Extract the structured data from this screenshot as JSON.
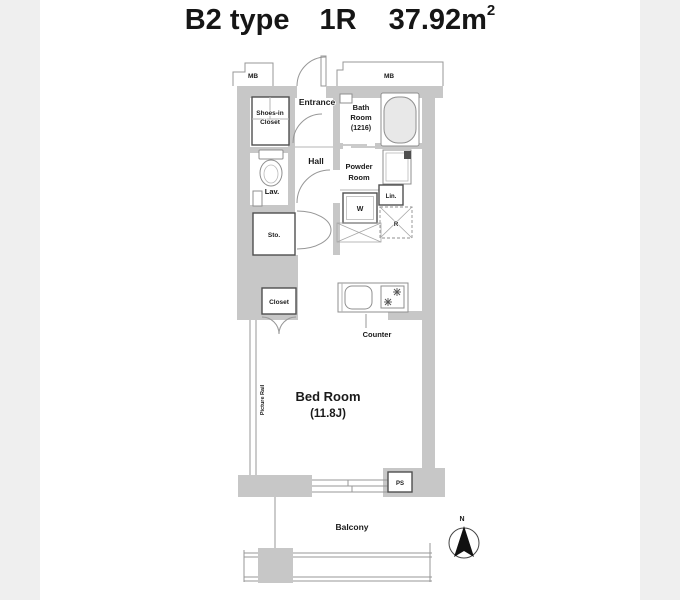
{
  "title": {
    "type": "B2 type",
    "layout": "1R",
    "area": "37.92m",
    "area_exponent": "2"
  },
  "labels": {
    "mb_left": "MB",
    "mb_right": "MB",
    "entrance": "Entrance",
    "shoes_closet_line1": "Shoes-in",
    "shoes_closet_line2": "Closet",
    "bath_line1": "Bath",
    "bath_line2": "Room",
    "bath_line3": "(1216)",
    "hall": "Hall",
    "powder_line1": "Powder",
    "powder_line2": "Room",
    "lavatory": "Lav.",
    "linen": "Lin.",
    "washer": "W",
    "refrigerator": "R",
    "storage": "Sto.",
    "closet": "Closet",
    "counter": "Counter",
    "bedroom_line1": "Bed Room",
    "bedroom_line2": "(11.8J)",
    "picture_rail": "Picture Rail",
    "pipe_space": "PS",
    "balcony": "Balcony",
    "compass_north": "N"
  },
  "colors": {
    "wall": "#c7c7c7",
    "canvas": "#ffffff",
    "side_band": "#efefef",
    "thin_line": "#979797",
    "dark_line": "#4f4f4f",
    "text": "#1a1a1a"
  }
}
